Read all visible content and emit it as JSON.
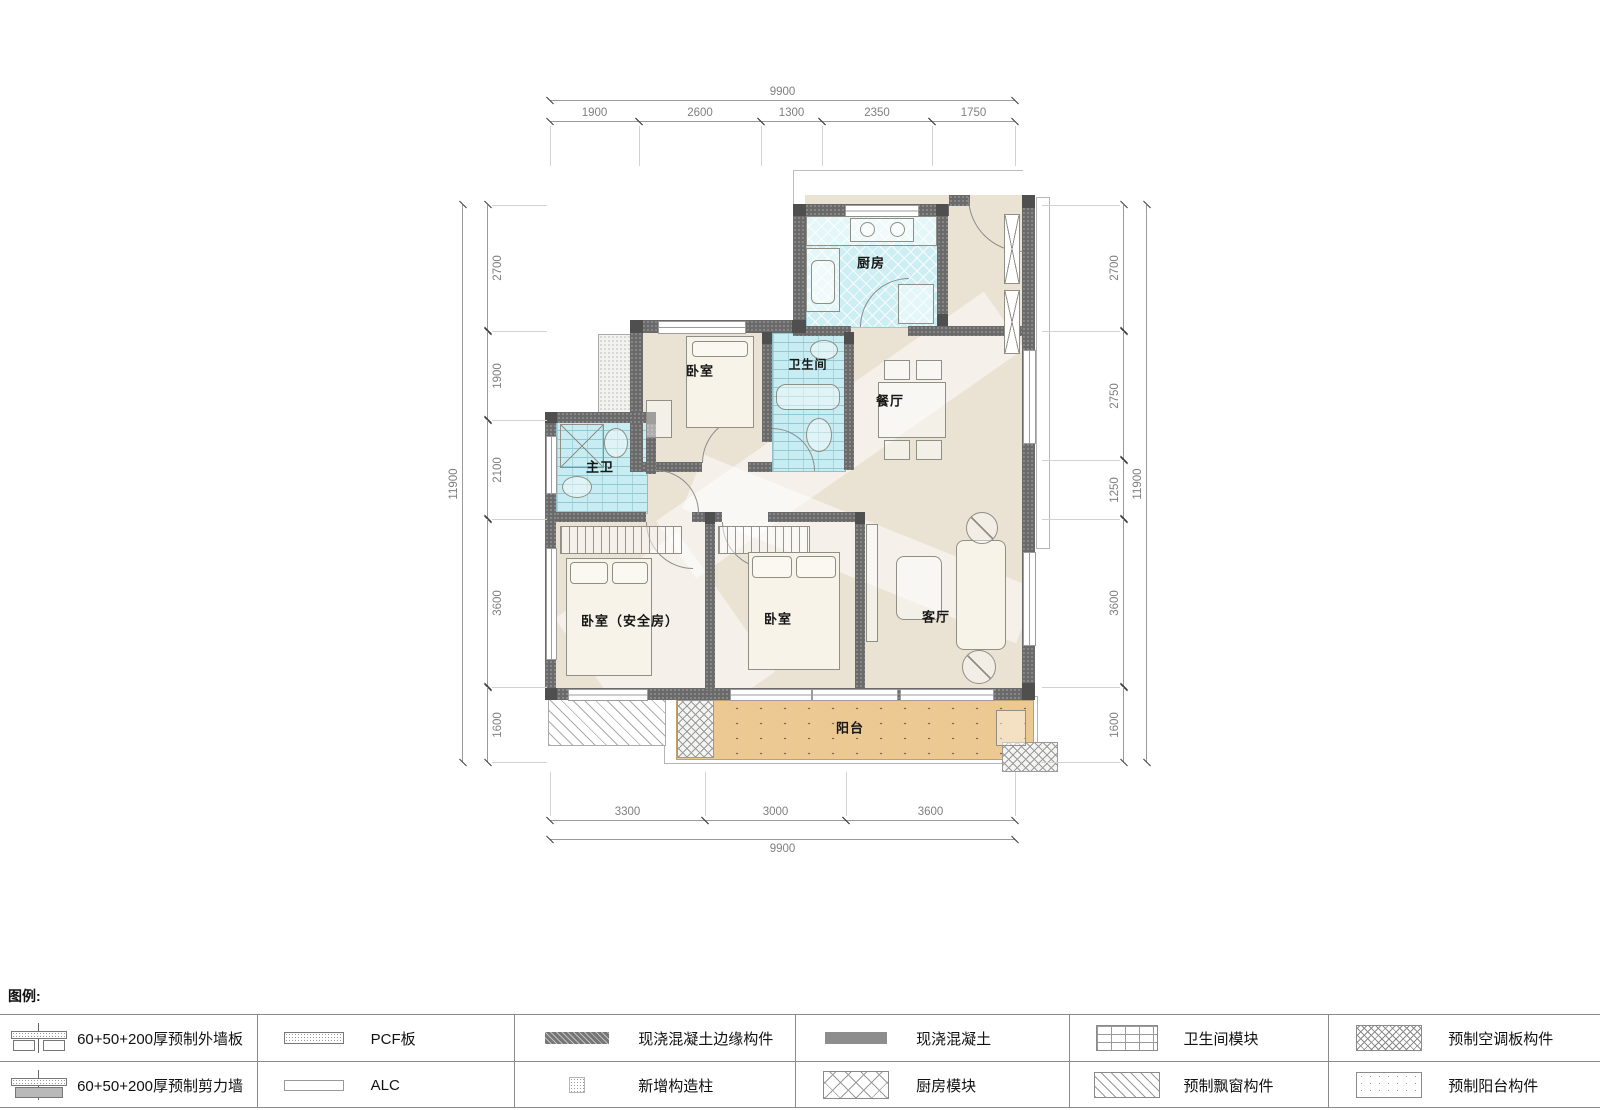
{
  "rooms": {
    "kitchen": "厨房",
    "bedroom_top": "卧室",
    "bath": "卫生间",
    "dining": "餐厅",
    "master_bath": "主卫",
    "bedroom_safe": "卧室（安全房）",
    "bedroom_mid": "卧室",
    "living": "客厅",
    "balcony": "阳台"
  },
  "dimensions": {
    "top": {
      "total": "9900",
      "segments": [
        "1900",
        "2600",
        "1300",
        "2350",
        "1750"
      ]
    },
    "bottom": {
      "total": "9900",
      "segments": [
        "3300",
        "3000",
        "3600"
      ]
    },
    "left": {
      "total": "11900",
      "segments": [
        "2700",
        "1900",
        "2100",
        "3600",
        "1600"
      ]
    },
    "right": {
      "total": "11900",
      "segments": [
        "2700",
        "2750",
        "1250",
        "3600",
        "1600"
      ]
    }
  },
  "legend": {
    "title": "图例:",
    "items": [
      {
        "symbol": "precast-exterior-wall",
        "label": "60+50+200厚预制外墙板"
      },
      {
        "symbol": "precast-shear-wall",
        "label": "60+50+200厚预制剪力墙"
      },
      {
        "symbol": "pcf-panel",
        "label": "PCF板"
      },
      {
        "symbol": "alc-panel",
        "label": "ALC"
      },
      {
        "symbol": "cast-in-place-edge",
        "label": "现浇混凝土边缘构件"
      },
      {
        "symbol": "new-structural-column",
        "label": "新增构造柱"
      },
      {
        "symbol": "cast-in-place-concrete",
        "label": "现浇混凝土"
      },
      {
        "symbol": "kitchen-module",
        "label": "厨房模块"
      },
      {
        "symbol": "bathroom-module",
        "label": "卫生间模块"
      },
      {
        "symbol": "precast-bay-window",
        "label": "预制飘窗构件"
      },
      {
        "symbol": "precast-ac-panel",
        "label": "预制空调板构件"
      },
      {
        "symbol": "precast-balcony",
        "label": "预制阳台构件"
      }
    ]
  },
  "colors": {
    "wall": "#6a6a6a",
    "floor": "#eae3d4",
    "kitchen_fill": "#cdeef2",
    "bath_fill": "#c7ecf2",
    "balcony_fill": "#ecc893"
  }
}
